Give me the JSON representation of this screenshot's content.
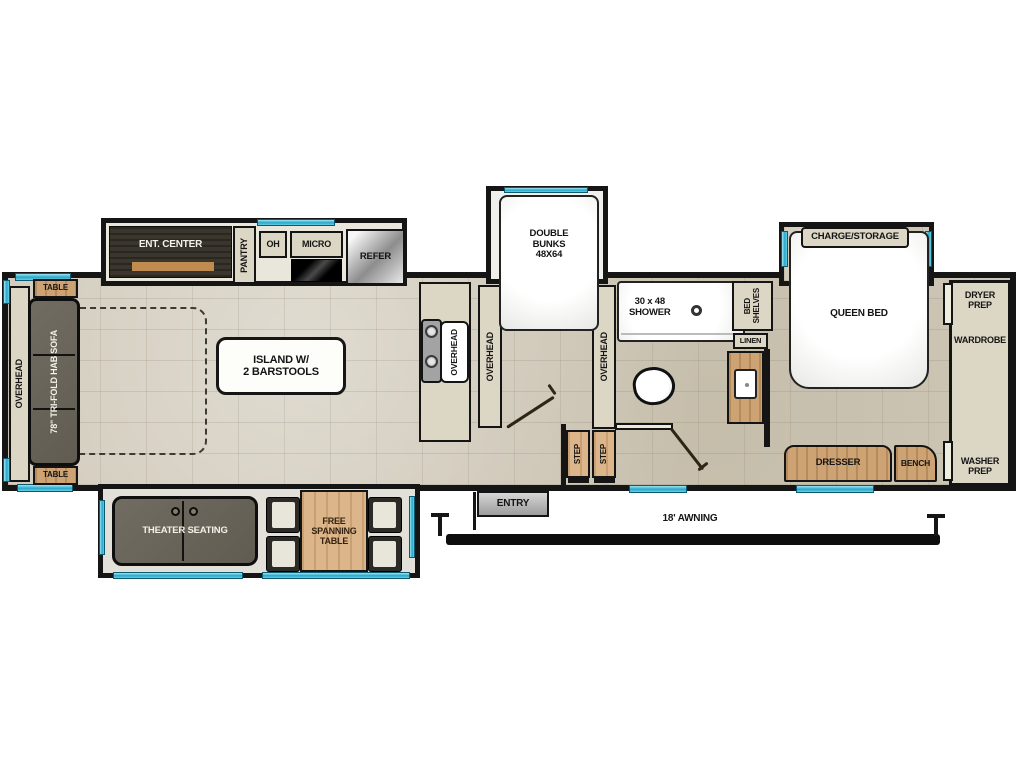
{
  "plan_title": "RV fifth-wheel floor plan",
  "colors": {
    "wall": "#151515",
    "floor": "#d0c9b9",
    "cabinet": "#dcd6c5",
    "wood": "#cda374",
    "dark_furniture": "#6a655b",
    "window_accent": "#2aa7c9",
    "white_fixture": "#ffffff"
  },
  "galley": {
    "ent_center": "ENT. CENTER",
    "pantry": "PANTRY",
    "oh": "OH",
    "micro": "MICRO",
    "refer": "REFER",
    "overhead_sink": "OVERHEAD",
    "overhead_left": "OVERHEAD",
    "overhead_right": "OVERHEAD"
  },
  "living": {
    "overhead_front": "OVERHEAD",
    "table_top": "TABLE",
    "table_bottom": "TABLE",
    "sofa": "78\" TRI-FOLD HAB SOFA",
    "island_line1": "ISLAND W/",
    "island_line2": "2 BARSTOOLS",
    "theater": "THEATER SEATING",
    "free_table_line1": "FREE",
    "free_table_line2": "SPANNING",
    "free_table_line3": "TABLE"
  },
  "bunks": {
    "line1": "DOUBLE",
    "line2": "BUNKS",
    "line3": "48X64"
  },
  "bath": {
    "shower_line1": "30 x 48",
    "shower_line2": "SHOWER",
    "bed_shelves_line1": "BED",
    "bed_shelves_line2": "SHELVES",
    "linen": "LINEN"
  },
  "bedroom": {
    "charge_storage": "CHARGE/STORAGE",
    "queen_bed": "QUEEN BED",
    "dresser": "DRESSER",
    "bench": "BENCH"
  },
  "rear": {
    "dryer_prep": "DRYER PREP",
    "wardrobe": "WARDROBE",
    "washer_prep": "WASHER PREP"
  },
  "entry": {
    "label": "ENTRY",
    "step1": "STEP",
    "step2": "STEP",
    "awning": "18' AWNING"
  }
}
